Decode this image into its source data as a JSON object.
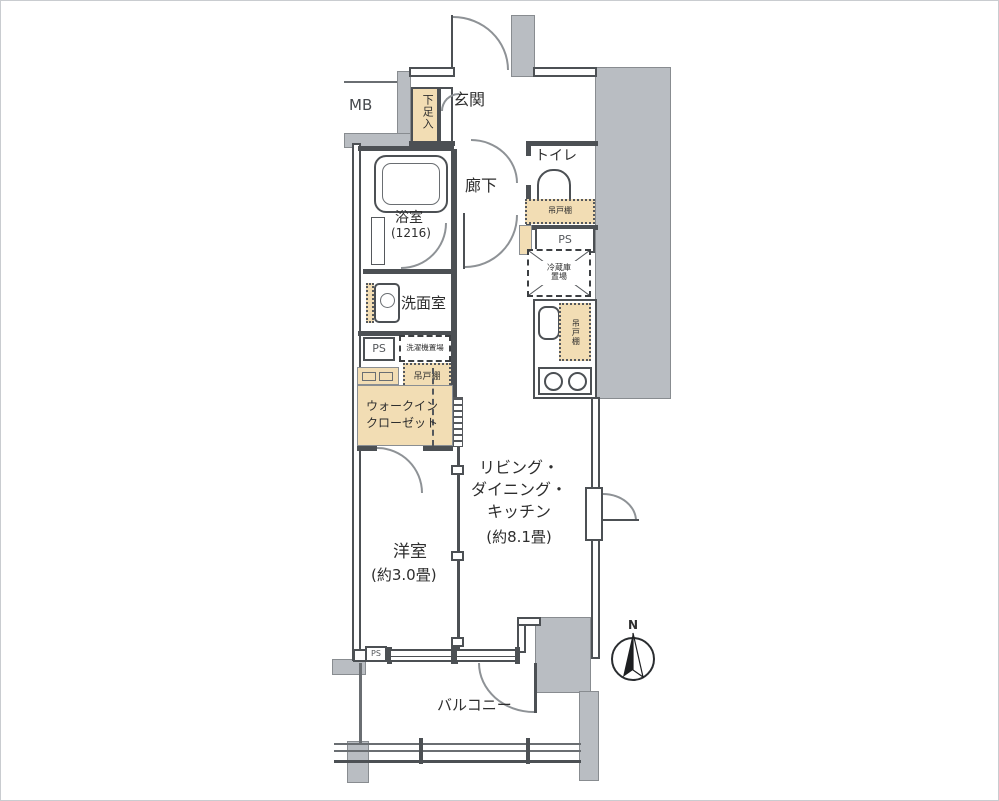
{
  "colors": {
    "wall": "#4c5054",
    "concrete_fill": "#b9bdc2",
    "storage_fill": "#f2ddb4",
    "floor": "#ffffff"
  },
  "rooms": {
    "meter_box": "MB",
    "entrance": "玄関",
    "shoe_storage": "下足入",
    "hallway": "廊下",
    "toilet": "トイレ",
    "bathroom": "浴室",
    "bathroom_size": "(1216)",
    "washroom": "洗面室",
    "walk_in_closet_line1": "ウォークイン",
    "walk_in_closet_line2": "クローゼット",
    "western_room": "洋室",
    "western_room_size": "(約3.0畳)",
    "ldk_line1": "リビング・",
    "ldk_line2": "ダイニング・",
    "ldk_line3": "キッチン",
    "ldk_size": "(約8.1畳)",
    "balcony": "バルコニー"
  },
  "fixtures": {
    "pipe_space": "PS",
    "toilet_shelf": "吊戸棚",
    "kitchen_shelf": "吊戸棚",
    "laundry_shelf": "吊戸棚",
    "fridge_line1": "冷蔵庫",
    "fridge_line2": "置場",
    "washer_place": "洗濯機置場"
  },
  "compass": {
    "north": "N"
  }
}
